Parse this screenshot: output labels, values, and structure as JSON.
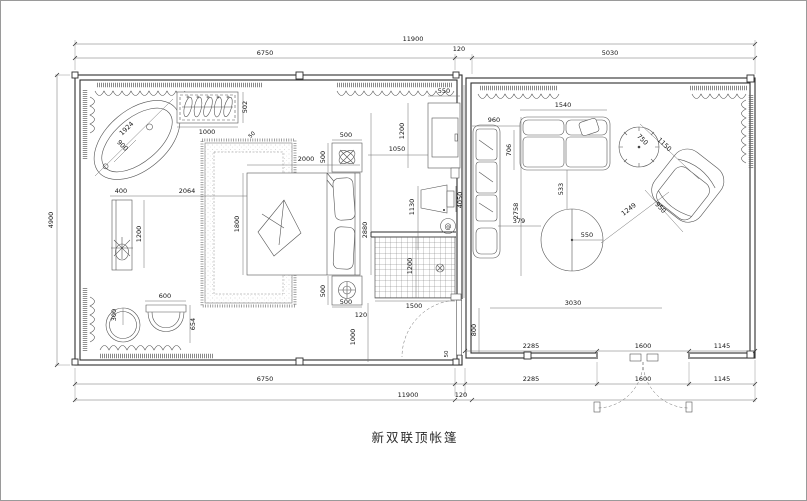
{
  "plan": {
    "title": "新双联顶帐篷",
    "colors": {
      "wall_line": "#2e2e2e",
      "furniture_line": "#555555",
      "dimension_line": "#6e6e6e",
      "dimension_text": "#141414",
      "background": "#ffffff",
      "frame_border": "#9a9a9a"
    },
    "symbols": {
      "socket": "@"
    },
    "dims": {
      "top_total": "11900",
      "top_left": "6750",
      "top_gap": "120",
      "top_right": "5030",
      "left_height": "4900",
      "bottom_left": "6750",
      "bottom_seg1": "2285",
      "bottom_seg2": "1600",
      "bottom_seg3": "1145",
      "bottom_total": "11900",
      "bottom_gap": "120",
      "inner_seg1": "2285",
      "inner_seg2": "1600",
      "inner_seg3": "1145",
      "tub_length": "1924",
      "tub_radius": "900",
      "closet_width": "1000",
      "closet_depth": "502",
      "rug_corner": "50",
      "vanity_width": "400",
      "vanity_to_bed": "2064",
      "vanity_length": "1200",
      "stool_radius": "300",
      "chair_width": "600",
      "chair_depth": "654",
      "bed_width": "2000",
      "bed_depth": "1800",
      "nightstand_top_width": "500",
      "nightstand_top_depth": "500",
      "nightstand_bottom_depth": "500",
      "nightstand_bottom_width": "500",
      "bed_zone_height": "2880",
      "bed_to_cabinet": "1050",
      "cabinet_width": "550",
      "cabinet_height": "1200",
      "tv_offset": "1130",
      "divider_wall": "4050",
      "shower_width": "1500",
      "shower_depth": "1200",
      "floor_gap": "120",
      "floor_offset": "1000",
      "door_width": "800",
      "door_jamb": "50",
      "sofa_width": "1540",
      "sofa_offset": "960",
      "sofa_depth": "706",
      "living_depth": "2758",
      "table_offset": "379",
      "table_radius": "550",
      "table_gap": "533",
      "table_to_chair": "1249",
      "side_table_dia": "750",
      "armchair_diag": "1150",
      "armchair_width": "950",
      "living_width": "3030"
    }
  }
}
